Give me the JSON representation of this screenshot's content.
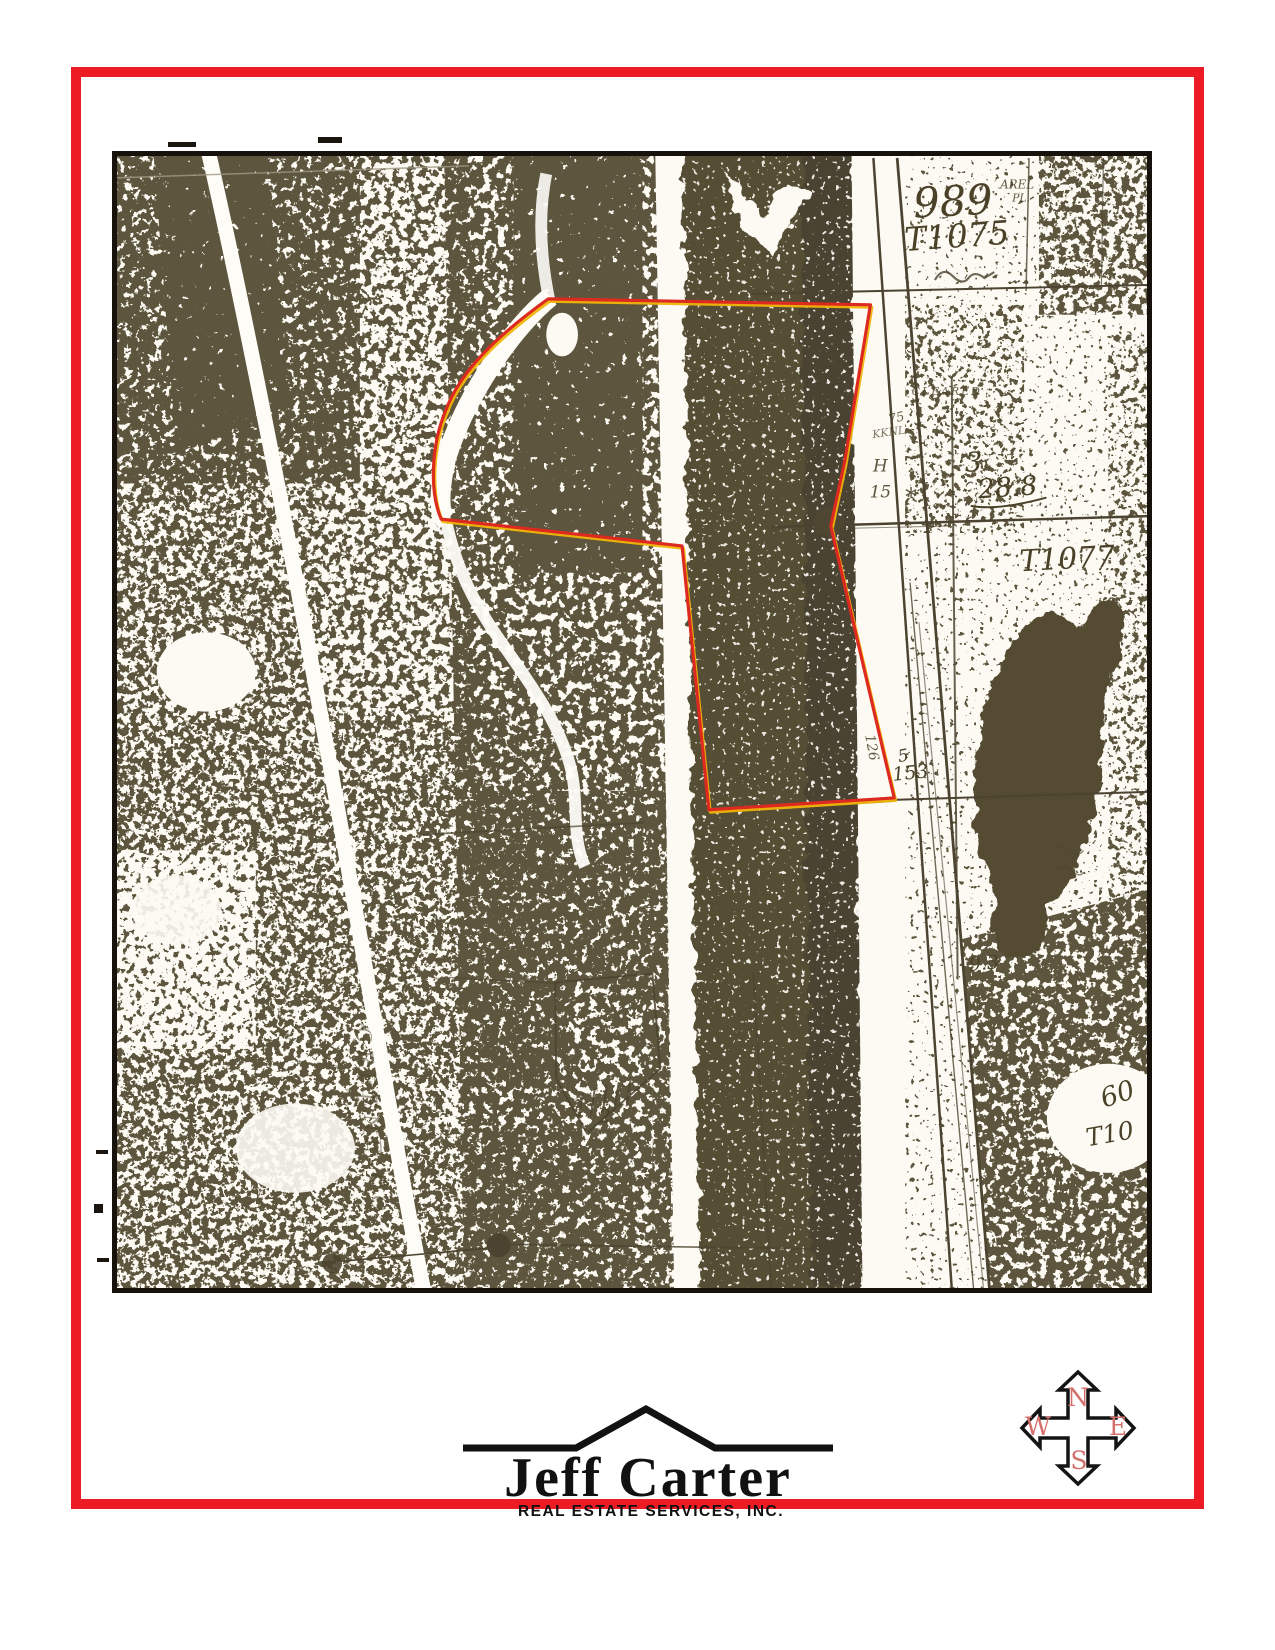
{
  "page": {
    "background": "#ffffff",
    "border_color": "#ec1b24"
  },
  "map": {
    "frame_color": "#17120c",
    "photo_ink_color": "#5d553c",
    "handwriting_color": "#4a4128",
    "outline_color": "#dc2a21",
    "outline_highlight_color": "#f0b50a",
    "annotations": [
      {
        "id": "parcel-989",
        "text": "989",
        "x": 844,
        "y": 60,
        "size": 42,
        "rotate": -3
      },
      {
        "id": "tract-t1075",
        "text": "T1075",
        "x": 848,
        "y": 92,
        "size": 33,
        "rotate": -4
      },
      {
        "id": "abel-pl-line1",
        "text": "AREL",
        "x": 908,
        "y": 33,
        "size": 12,
        "opacity": 0.85
      },
      {
        "id": "abel-pl-line2",
        "text": "PL.",
        "x": 912,
        "y": 46,
        "size": 11,
        "opacity": 0.85
      },
      {
        "id": "cleared-label",
        "text": "CLEARED",
        "x": 837,
        "y": 241,
        "size": 11,
        "opacity": 0.8,
        "spacing": 2
      },
      {
        "id": "note-75",
        "text": "75",
        "x": 787,
        "y": 268,
        "size": 13,
        "rotate": -12,
        "opacity": 0.8
      },
      {
        "id": "note-kknl",
        "text": "KKNL",
        "x": 779,
        "y": 282,
        "size": 11,
        "rotate": -8,
        "opacity": 0.7
      },
      {
        "id": "note-h",
        "text": "H",
        "x": 770,
        "y": 318,
        "size": 17,
        "opacity": 0.9
      },
      {
        "id": "note-15",
        "text": "15",
        "x": 770,
        "y": 344,
        "size": 17,
        "opacity": 0.9
      },
      {
        "id": "note-star",
        "text": "*",
        "x": 801,
        "y": 352,
        "size": 24,
        "opacity": 0.85
      },
      {
        "id": "note-3",
        "text": "3",
        "x": 864,
        "y": 318,
        "size": 27
      },
      {
        "id": "acreage-288",
        "text": "28.8",
        "x": 899,
        "y": 343,
        "size": 27,
        "rotate": -4,
        "underline": true
      },
      {
        "id": "tract-t1077",
        "text": "T1077",
        "x": 959,
        "y": 416,
        "size": 30,
        "rotate": -3
      },
      {
        "id": "note-5",
        "text": "5",
        "x": 794,
        "y": 610,
        "size": 17,
        "rotate": -10
      },
      {
        "id": "note-153",
        "text": "153",
        "x": 801,
        "y": 628,
        "size": 19,
        "rotate": -6
      },
      {
        "id": "bearing-126",
        "text": "126",
        "x": 757,
        "y": 597,
        "size": 14,
        "rotate": 80,
        "opacity": 0.85
      },
      {
        "id": "note-93",
        "text": "9.3",
        "x": 875,
        "y": 820,
        "size": 19,
        "rotate": -5
      },
      {
        "id": "note-60",
        "text": "60",
        "x": 1012,
        "y": 954,
        "size": 27,
        "rotate": -18
      },
      {
        "id": "tract-t10",
        "text": "T10",
        "x": 1003,
        "y": 994,
        "size": 25,
        "rotate": -10
      },
      {
        "id": "lot-2",
        "text": "2",
        "x": 492,
        "y": 974,
        "size": 19
      },
      {
        "id": "greene-label",
        "text": "GREENE CO",
        "x": 250,
        "y": 975,
        "size": 20,
        "rotate": 85,
        "opacity": 0.5,
        "spacing": 7
      }
    ]
  },
  "logo": {
    "name": "Jeff Carter",
    "subtitle": "REAL ESTATE SERVICES, INC."
  },
  "compass": {
    "north": "N",
    "east": "E",
    "south": "S",
    "west": "W",
    "letter_color": "#d4706c"
  }
}
